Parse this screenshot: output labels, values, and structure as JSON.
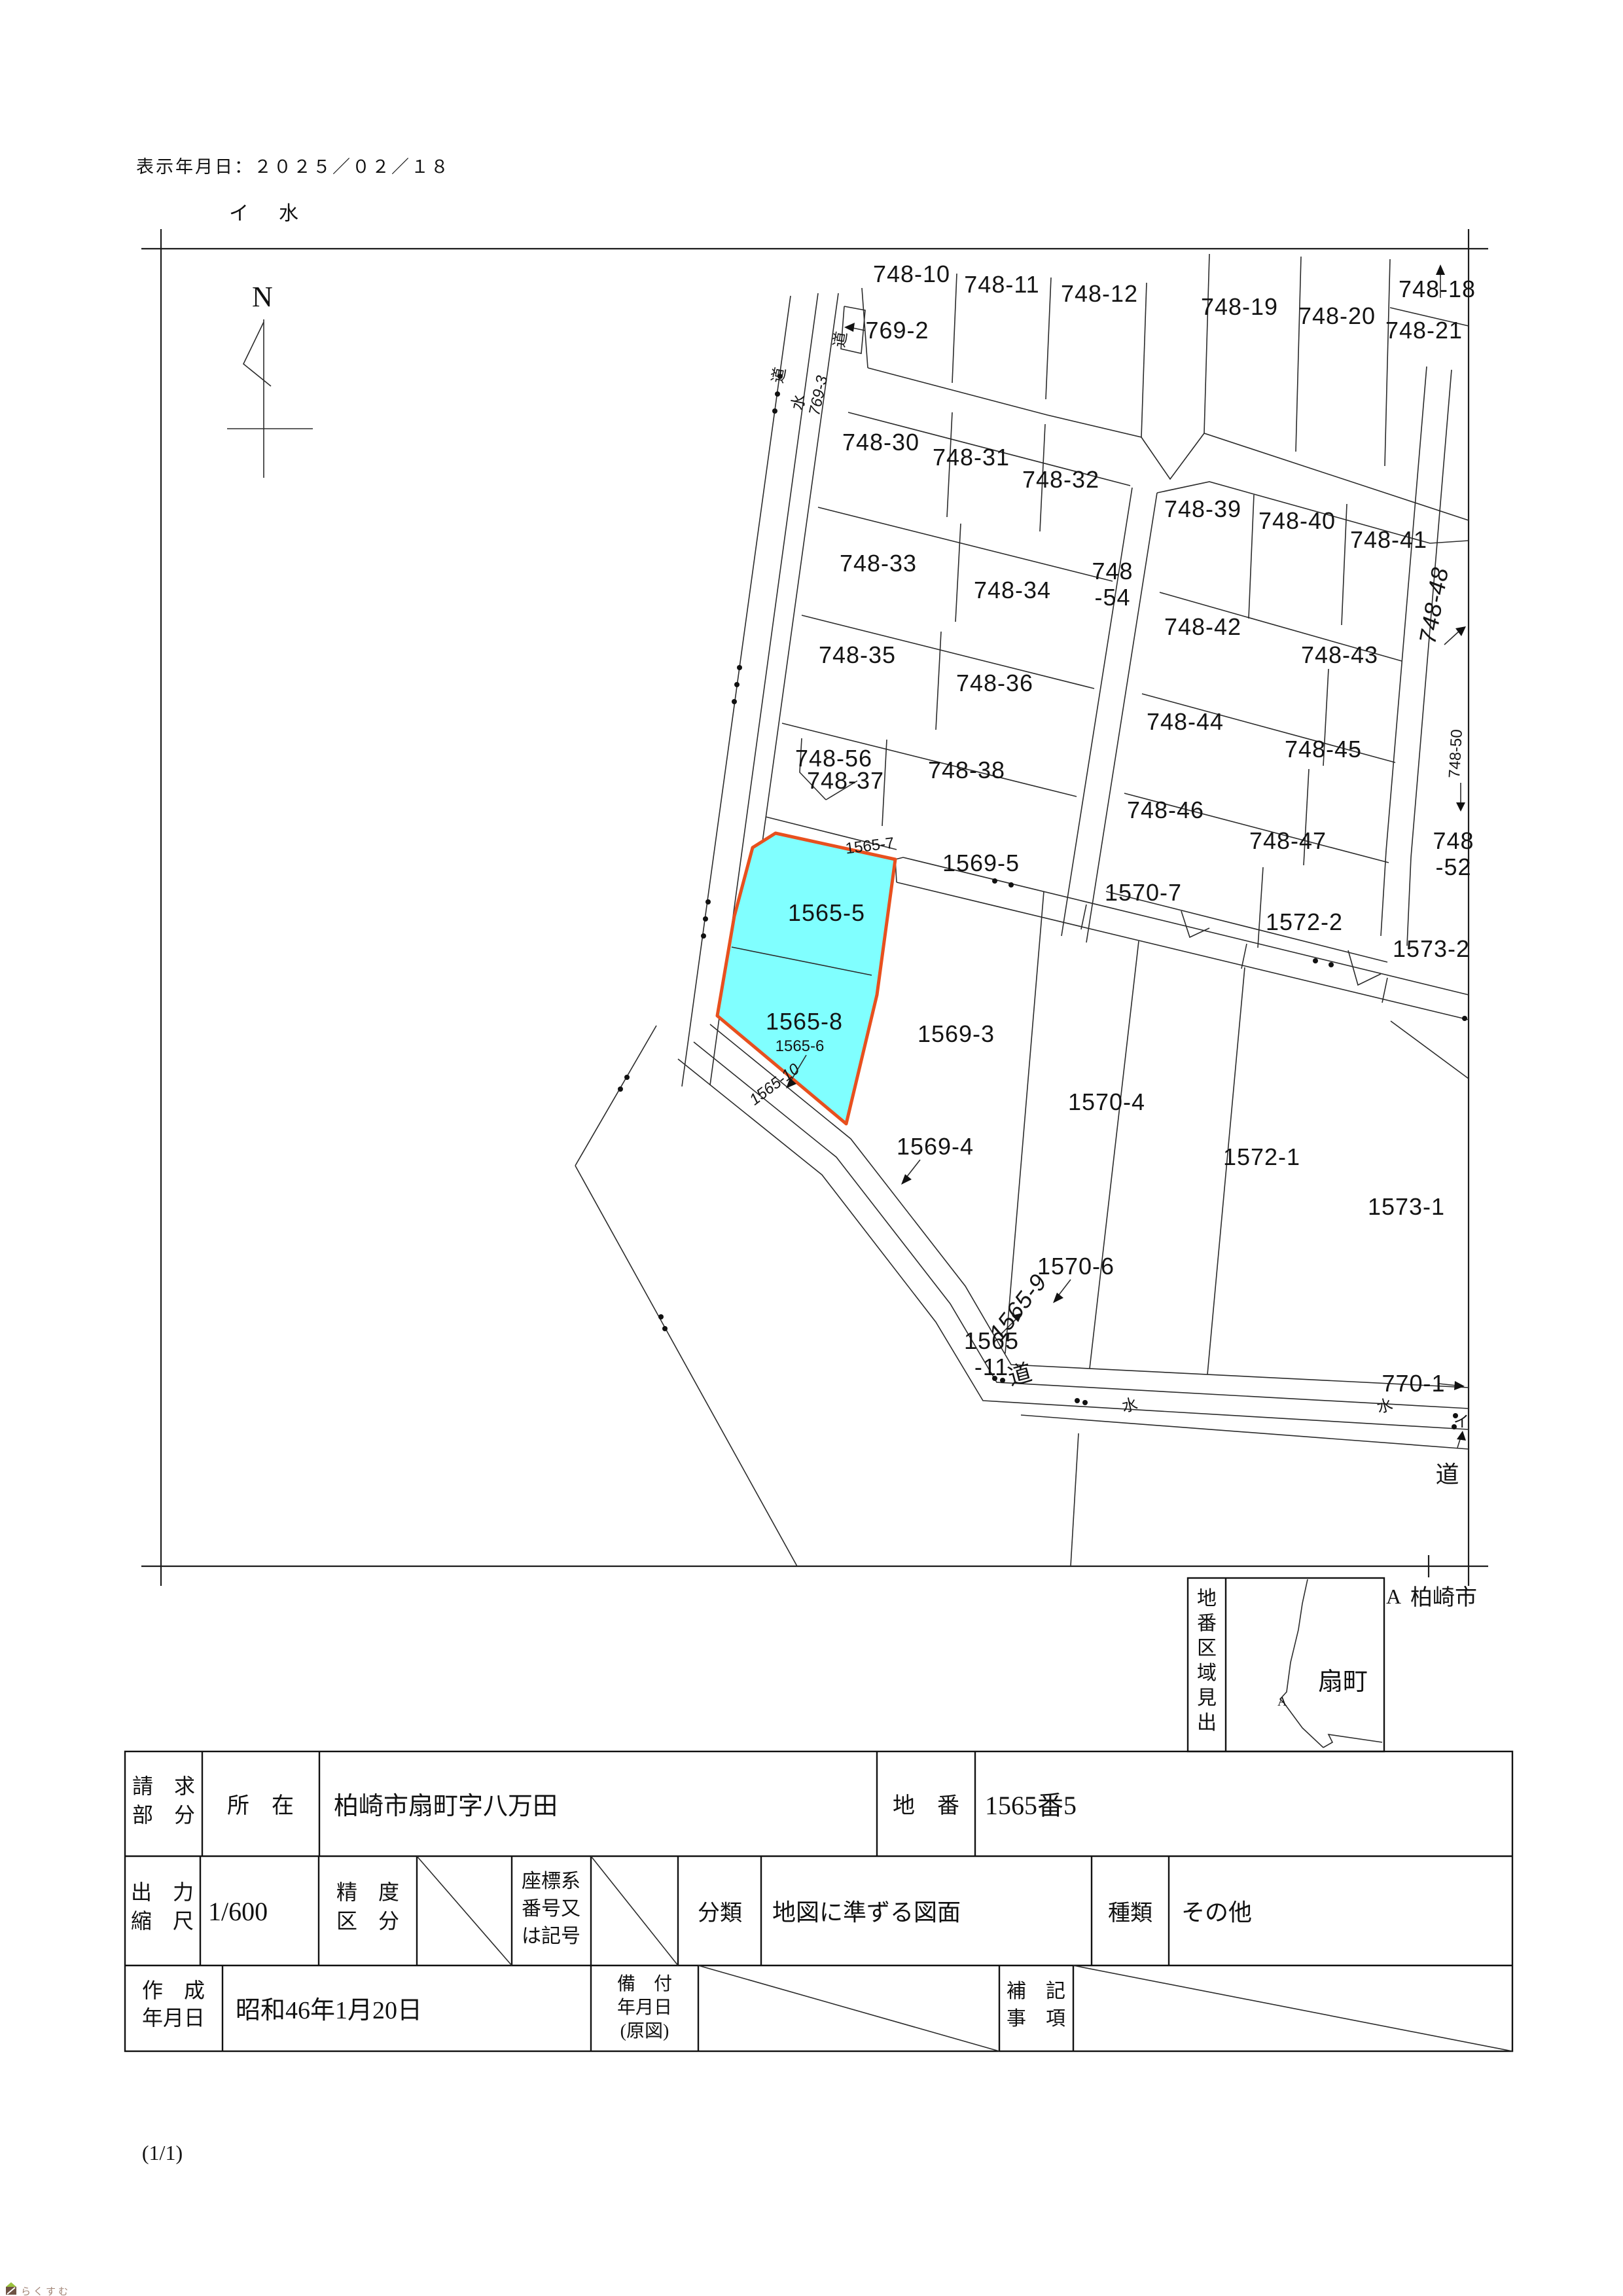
{
  "page": {
    "display_date": "表示年月日：２０２５／０２／１８",
    "page_indicator": "(1/1)",
    "watermark_text": "らくすむ"
  },
  "map": {
    "north_label": "N",
    "header_annotation": "イ　水",
    "labels": {
      "l769_2": "769-2",
      "l748_10": "748-10",
      "l748_11": "748-11",
      "l748_12": "748-12",
      "l748_19": "748-19",
      "l748_20": "748-20",
      "l748_18": "748-18",
      "l748_21": "748-21",
      "l748_30": "748-30",
      "l748_31": "748-31",
      "l748_32": "748-32",
      "l748_39": "748-39",
      "l748_40": "748-40",
      "l748_41": "748-41",
      "l748_33": "748-33",
      "l748_34": "748-34",
      "l748_54a": "748",
      "l748_54b": "-54",
      "l748_42": "748-42",
      "l748_43": "748-43",
      "l748_48": "748-48",
      "l748_35": "748-35",
      "l748_36": "748-36",
      "l748_44": "748-44",
      "l748_45": "748-45",
      "l748_50": "748-50",
      "l748_56": "748-56",
      "l748_37": "748-37",
      "l748_38": "748-38",
      "l748_46": "748-46",
      "l748_47": "748-47",
      "l748_52a": "748",
      "l748_52b": "-52",
      "l1565_7": "1565-7",
      "l1569_5": "1569-5",
      "l1570_7": "1570-7",
      "l1572_2": "1572-2",
      "l1573_2": "1573-2",
      "l1565_5": "1565-5",
      "l1565_8": "1565-8",
      "l1565_6": "1565-6",
      "l1569_3": "1569-3",
      "l1565_10": "1565-10",
      "l1570_4": "1570-4",
      "l1569_4": "1569-4",
      "l1572_1": "1572-1",
      "l1573_1": "1573-1",
      "l1570_6": "1570-6",
      "l1565_9": "1565-9",
      "l1565_11a": "1565",
      "l1565_11b": "-11",
      "l770_1": "770-1",
      "road_do": "道",
      "road_mizu": "水",
      "road_mizu_right": "水",
      "road_i": "イ",
      "road_do_big": "道",
      "strip_do": "道",
      "strip_mizu": "水",
      "strip_769_3": "769-3",
      "strip_do_top": "道"
    },
    "highlight_fill": "#80FFFF",
    "highlight_stroke": "#E8501E"
  },
  "locator": {
    "side_title": "地番区域見出",
    "area_name": "扇町",
    "inner_marker": "A",
    "outer_marker": "A",
    "city": "柏崎市"
  },
  "table": {
    "row1": {
      "h_request_l1": "請　求",
      "h_request_l2": "部　分",
      "h_location": "所　在",
      "v_location": "柏崎市扇町字八万田",
      "h_chiban": "地　番",
      "v_chiban": "1565番5"
    },
    "row2": {
      "h_scale_l1": "出　力",
      "h_scale_l2": "縮　尺",
      "v_scale": "1/600",
      "h_precision_l1": "精　度",
      "h_precision_l2": "区　分",
      "h_coord_l1": "座標系",
      "h_coord_l2": "番号又",
      "h_coord_l3": "は記号",
      "h_class": "分類",
      "v_class": "地図に準ずる図面",
      "h_kind": "種類",
      "v_kind": "その他"
    },
    "row3": {
      "h_created_l1": "作　成",
      "h_created_l2": "年月日",
      "v_created": "昭和46年1月20日",
      "h_equipped_l1": "備　付",
      "h_equipped_l2": "年月日",
      "h_equipped_l3": "(原図)",
      "h_note_l1": "補　記",
      "h_note_l2": "事　項"
    }
  }
}
